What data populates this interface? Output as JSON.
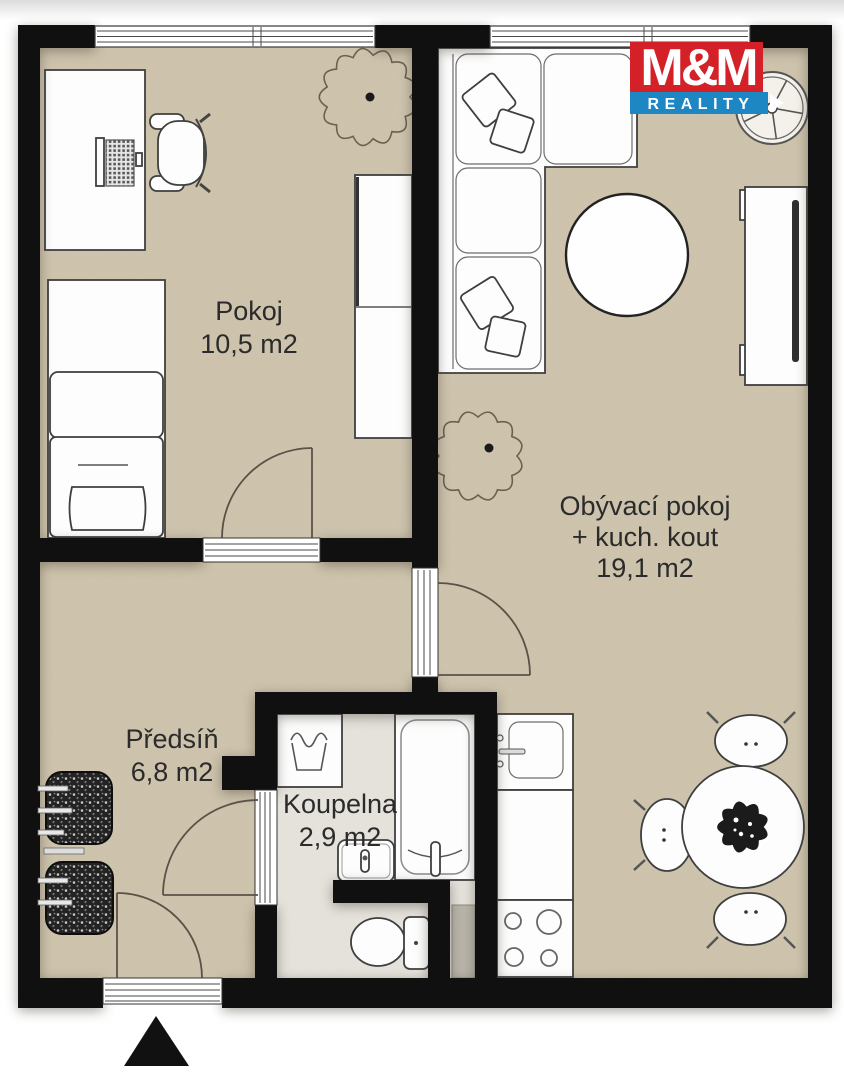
{
  "logo": {
    "top": "M&M",
    "bottom": "REALITY",
    "colors": {
      "red": "#d42127",
      "blue": "#1d87c4",
      "text": "#ffffff"
    }
  },
  "rooms": {
    "pokoj": {
      "name": "Pokoj",
      "area": "10,5 m2"
    },
    "living": {
      "line1": "Obývací pokoj",
      "line2": "+ kuch. kout",
      "area": "19,1 m2"
    },
    "hall": {
      "name": "Předsíň",
      "area": "6,8 m2"
    },
    "bath": {
      "name": "Koupelna",
      "area": "2,9 m2"
    }
  },
  "colors": {
    "wall": "#101010",
    "floor": "#d0c5ae",
    "bath_floor": "#e9e6e0",
    "outline": "#3f3f3f",
    "label": "#2b2b2b"
  },
  "compass": {
    "type": "north-arrow",
    "shape": "triangle-up"
  },
  "furniture": [
    "desk",
    "laptop",
    "office-chair",
    "bed",
    "wardrobe",
    "plant",
    "sofa",
    "pillows",
    "round-table",
    "tv-cabinet",
    "wheel-decor",
    "plant",
    "dining-table",
    "dining-chair",
    "dining-chair",
    "dining-chair",
    "kitchen-sink",
    "kitchen-counter",
    "stove",
    "washing-machine",
    "bathtub",
    "hand-sink",
    "toilet",
    "radiator",
    "coat-rack",
    "coat-rack"
  ]
}
